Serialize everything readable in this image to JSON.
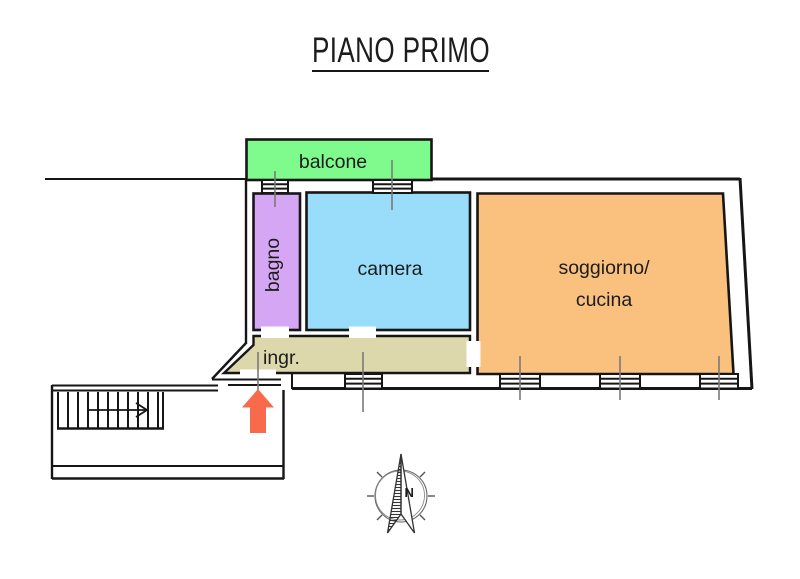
{
  "title": "PIANO PRIMO",
  "rooms": {
    "balcone": {
      "label": "balcone",
      "color": "#7efb8c"
    },
    "bagno": {
      "label": "bagno",
      "color": "#d5a6f3"
    },
    "camera": {
      "label": "camera",
      "color": "#99ddfb"
    },
    "soggiorno": {
      "line1": "soggiorno/",
      "line2": "cucina",
      "color": "#f9c07e"
    },
    "ingresso": {
      "label": "ingr.",
      "color": "#dcd8ab"
    }
  },
  "compass": {
    "north_label": "N",
    "icon": "north-compass-rose"
  },
  "icons": {
    "entrance_arrow": "up-arrow",
    "stairs": "staircase-with-direction-arrow",
    "windows": "window-ladder-symbol"
  },
  "colors": {
    "wall": "#161616",
    "entrance_arrow": "#f76b4c",
    "centerline_gray": "#7a7a7a"
  }
}
